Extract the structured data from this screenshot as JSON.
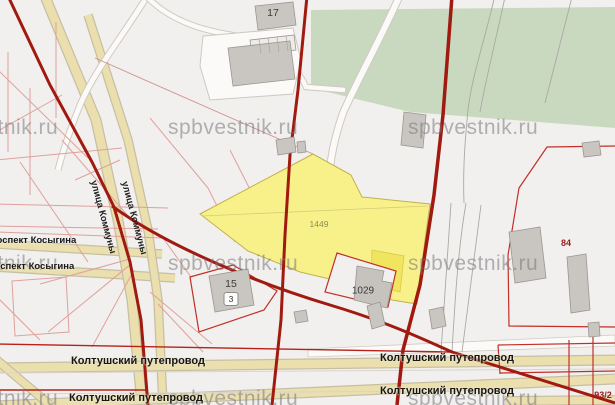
{
  "watermark": {
    "text": "spbvestnik.ru"
  },
  "streets": {
    "kosygina_1": "проспект Косыгина",
    "kosygina_2": "проспект Косыгина",
    "kommuny_1": "улица Коммуны",
    "kommuny_2": "улица Коммуны",
    "koltushsky_1": "Колтушский путепровод",
    "koltushsky_2": "Колтушский путепровод",
    "koltushsky_3": "Колтушский путепровод",
    "koltushsky_4": "Колтушский путепровод"
  },
  "parcels": {
    "yellow_main": "1449",
    "inner_white": "1029",
    "right_block": "84",
    "bottom_right": "93/2"
  },
  "buildings": {
    "garage_block": "17",
    "house_15": "15",
    "house_15_sub": "3"
  },
  "colors": {
    "background": "#f2f0ee",
    "forest_green": "#c9d9c0",
    "parcel_yellow": "#f8f18a",
    "road_dark_red": "#a01a10",
    "road_beige": "#ebdfae",
    "cadastral_pink": "#dfa09c",
    "boundary_red": "#c03028",
    "building_gray": "#c9c6c1",
    "watermark_gray": "#76767c"
  }
}
